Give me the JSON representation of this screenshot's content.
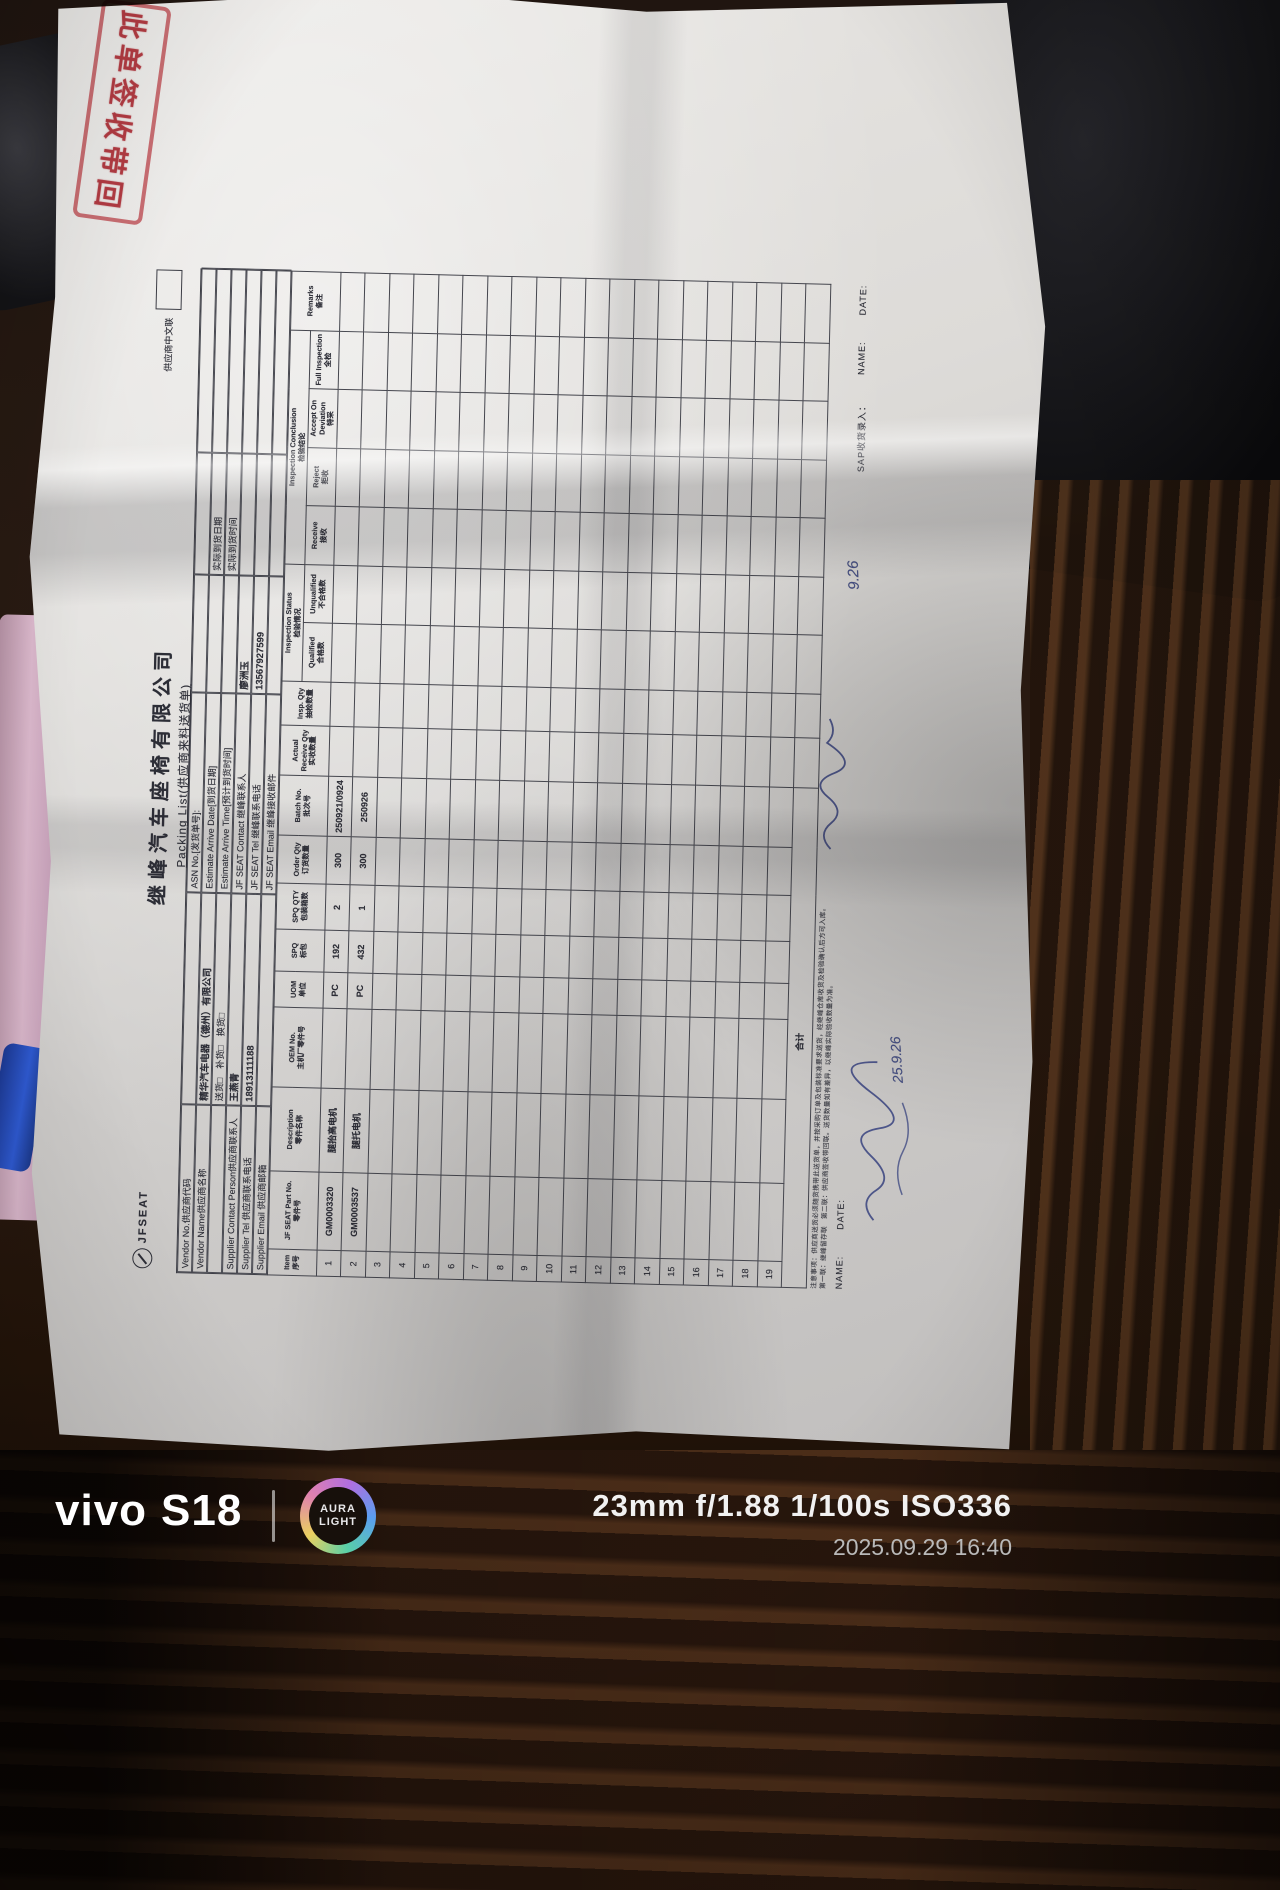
{
  "photo": {
    "camera_info": "23mm  f/1.88  1/100s  ISO336",
    "datetime": "2025.09.29 16:40",
    "brand": "vivo",
    "model": "S18",
    "logo_line1": "AURA",
    "logo_line2": "LIGHT"
  },
  "stamp": {
    "text": "此单签收带回",
    "color": "#ba2c36"
  },
  "document": {
    "logo_text": "JFSEAT",
    "title": "继峰汽车座椅有限公司",
    "subtitle": "Packing List(供应商来料送货单)",
    "copy_label": "供应商中文联",
    "header": {
      "vendor_no_label": "Vendor No.供应商代码",
      "vendor_no_value": "",
      "asn_label": "ASN No.[发货单号]:",
      "asn_value": "",
      "vendor_name_label": "Vendor Name供应商名称",
      "vendor_name_value": "精华汽车电器（德州）有限公司",
      "est_date_label": "Estimate Arrive Date[到货日期]",
      "est_date_value": "",
      "actual_date_label": "实际到货日期",
      "actual_date_value": "",
      "delivery_type_options": "送货□　补货□　换货□",
      "est_time_label": "Estimate Arrive Time[预计到货时间]",
      "est_time_value": "",
      "actual_time_label": "实际到货时间",
      "actual_time_value": "",
      "supplier_contact_label": "Supplier Contact Person供应商联系人",
      "supplier_contact_value": "王燕青",
      "jf_contact_label": "JF SEAT Contact 继峰联系人",
      "jf_contact_value": "廖洲玉",
      "supplier_tel_label": "Supplier Tel 供应商联系电话",
      "supplier_tel_value": "18913111188",
      "jf_tel_label": "JF SEAT Tel 继峰联系电话",
      "jf_tel_value": "13567927599",
      "supplier_email_label": "Supplier Email 供应商邮箱",
      "supplier_email_value": "",
      "jf_email_label": "JF SEAT Email 继峰接收邮件",
      "jf_email_value": ""
    },
    "table": {
      "groups": {
        "status_en": "Inspection Status",
        "status_cn": "检验情况",
        "conclusion_en": "Inspection Conclusion",
        "conclusion_cn": "检验结论"
      },
      "columns": [
        {
          "en": "Item",
          "cn": "序号"
        },
        {
          "en": "JF SEAT Part No.",
          "cn": "零件号"
        },
        {
          "en": "Description",
          "cn": "零件名称"
        },
        {
          "en": "OEM No.",
          "cn": "主机厂零件号"
        },
        {
          "en": "UOM",
          "cn": "单位"
        },
        {
          "en": "SPQ",
          "cn": "标包"
        },
        {
          "en": "SPQ QTY",
          "cn": "包装箱数"
        },
        {
          "en": "Order Qty",
          "cn": "订货数量"
        },
        {
          "en": "Batch No.",
          "cn": "批次号"
        },
        {
          "en": "Actual Receive Qty",
          "cn": "实收数量"
        },
        {
          "en": "Insp. Qty",
          "cn": "抽检数量"
        },
        {
          "en": "Qualified",
          "cn": "合格数"
        },
        {
          "en": "Unqualified",
          "cn": "不合格数"
        },
        {
          "en": "Receive",
          "cn": "接收"
        },
        {
          "en": "Reject",
          "cn": "拒收"
        },
        {
          "en": "Accept On Deviation",
          "cn": "特采"
        },
        {
          "en": "Full Inspection",
          "cn": "全检"
        },
        {
          "en": "Remarks",
          "cn": "备注"
        }
      ],
      "rows": [
        [
          "1",
          "GM0003320",
          "腿抬高电机",
          "",
          "PC",
          "192",
          "2",
          "300",
          "250921/0924",
          "",
          "",
          "",
          "",
          "",
          "",
          "",
          "",
          ""
        ],
        [
          "2",
          "GM0003537",
          "腿托电机",
          "",
          "PC",
          "432",
          "1",
          "300",
          "250926",
          "",
          "",
          "",
          "",
          "",
          "",
          "",
          "",
          ""
        ],
        [
          "3",
          "",
          "",
          "",
          "",
          "",
          "",
          "",
          "",
          "",
          "",
          "",
          "",
          "",
          "",
          "",
          "",
          ""
        ],
        [
          "4",
          "",
          "",
          "",
          "",
          "",
          "",
          "",
          "",
          "",
          "",
          "",
          "",
          "",
          "",
          "",
          "",
          ""
        ],
        [
          "5",
          "",
          "",
          "",
          "",
          "",
          "",
          "",
          "",
          "",
          "",
          "",
          "",
          "",
          "",
          "",
          "",
          ""
        ],
        [
          "6",
          "",
          "",
          "",
          "",
          "",
          "",
          "",
          "",
          "",
          "",
          "",
          "",
          "",
          "",
          "",
          "",
          ""
        ],
        [
          "7",
          "",
          "",
          "",
          "",
          "",
          "",
          "",
          "",
          "",
          "",
          "",
          "",
          "",
          "",
          "",
          "",
          ""
        ],
        [
          "8",
          "",
          "",
          "",
          "",
          "",
          "",
          "",
          "",
          "",
          "",
          "",
          "",
          "",
          "",
          "",
          "",
          ""
        ],
        [
          "9",
          "",
          "",
          "",
          "",
          "",
          "",
          "",
          "",
          "",
          "",
          "",
          "",
          "",
          "",
          "",
          "",
          ""
        ],
        [
          "10",
          "",
          "",
          "",
          "",
          "",
          "",
          "",
          "",
          "",
          "",
          "",
          "",
          "",
          "",
          "",
          "",
          ""
        ],
        [
          "11",
          "",
          "",
          "",
          "",
          "",
          "",
          "",
          "",
          "",
          "",
          "",
          "",
          "",
          "",
          "",
          "",
          ""
        ],
        [
          "12",
          "",
          "",
          "",
          "",
          "",
          "",
          "",
          "",
          "",
          "",
          "",
          "",
          "",
          "",
          "",
          "",
          ""
        ],
        [
          "13",
          "",
          "",
          "",
          "",
          "",
          "",
          "",
          "",
          "",
          "",
          "",
          "",
          "",
          "",
          "",
          "",
          ""
        ],
        [
          "14",
          "",
          "",
          "",
          "",
          "",
          "",
          "",
          "",
          "",
          "",
          "",
          "",
          "",
          "",
          "",
          "",
          ""
        ],
        [
          "15",
          "",
          "",
          "",
          "",
          "",
          "",
          "",
          "",
          "",
          "",
          "",
          "",
          "",
          "",
          "",
          "",
          ""
        ],
        [
          "16",
          "",
          "",
          "",
          "",
          "",
          "",
          "",
          "",
          "",
          "",
          "",
          "",
          "",
          "",
          "",
          "",
          ""
        ],
        [
          "17",
          "",
          "",
          "",
          "",
          "",
          "",
          "",
          "",
          "",
          "",
          "",
          "",
          "",
          "",
          "",
          "",
          ""
        ],
        [
          "18",
          "",
          "",
          "",
          "",
          "",
          "",
          "",
          "",
          "",
          "",
          "",
          "",
          "",
          "",
          "",
          "",
          ""
        ],
        [
          "19",
          "",
          "",
          "",
          "",
          "",
          "",
          "",
          "",
          "",
          "",
          "",
          "",
          "",
          "",
          "",
          "",
          ""
        ]
      ],
      "total_label": "合计"
    },
    "footer": {
      "fine_print_1": "注意事项：供应商送货必须随货携带此送货单，并按采购订单及包装标准要求送货，经继峰仓库收货及检验确认后方可入库。",
      "fine_print_2": "第一联：继峰留存联　第二联：供应商签收带回联。送货数量如有差异，以继峰实际验收数量为准。",
      "left_name_label": "NAME:",
      "left_date_label": "DATE:",
      "sap_label": "SAP收货录入：",
      "sap_name_label": "NAME:",
      "sap_date_label": "DATE:",
      "handwriting_date_1": "9.26",
      "handwriting_date_2": "25.9.26"
    }
  }
}
